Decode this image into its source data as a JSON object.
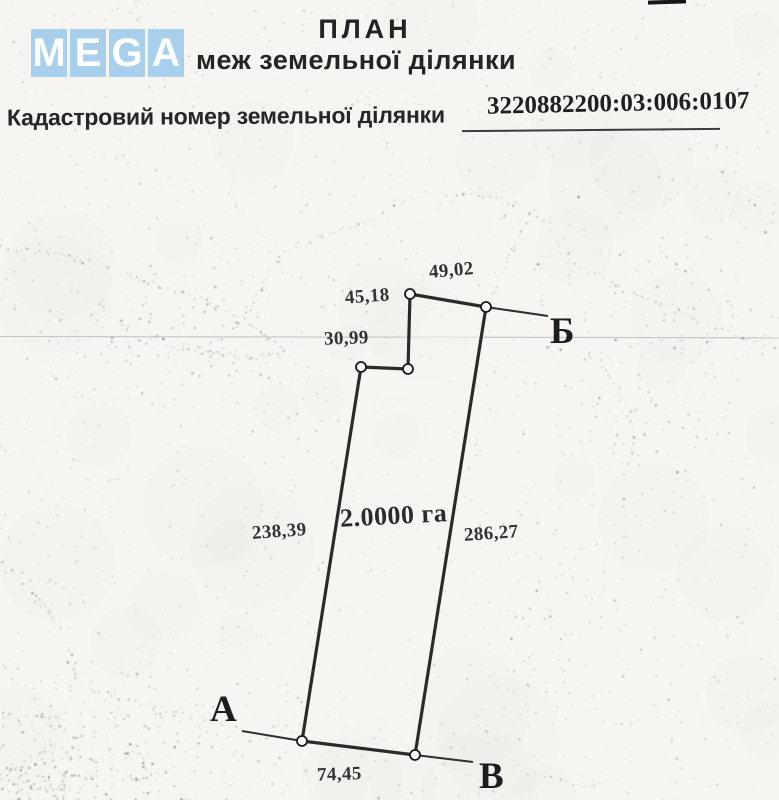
{
  "logo": {
    "letters": [
      "M",
      "E",
      "G",
      "A"
    ],
    "tile_color": "#a8d0ec",
    "letter_color": "#ffffff"
  },
  "header": {
    "title": "ПЛАН",
    "subtitle": "меж земельної ділянки"
  },
  "cadastral": {
    "label": "Кадастровий номер земельної ділянки",
    "number": "3220882200:03:006:0107"
  },
  "plan": {
    "area_label": "2.0000 га",
    "ink_color": "#1a1a1a",
    "vertices": [
      {
        "x": 410,
        "y": 294
      },
      {
        "x": 486,
        "y": 307
      },
      {
        "x": 415,
        "y": 755
      },
      {
        "x": 302,
        "y": 741
      },
      {
        "x": 361,
        "y": 367
      },
      {
        "x": 408,
        "y": 369
      }
    ],
    "extensions": [
      {
        "x1": 486,
        "y1": 307,
        "x2": 548,
        "y2": 316
      },
      {
        "x1": 242,
        "y1": 731,
        "x2": 302,
        "y2": 741
      },
      {
        "x1": 415,
        "y1": 755,
        "x2": 473,
        "y2": 762
      }
    ],
    "dimensions": [
      {
        "text": "49,02"
      },
      {
        "text": "45,18"
      },
      {
        "text": "30,99"
      },
      {
        "text": "238,39"
      },
      {
        "text": "286,27"
      },
      {
        "text": "74,45"
      }
    ],
    "points": [
      {
        "text": "А"
      },
      {
        "text": "Б"
      },
      {
        "text": "В"
      }
    ],
    "artifact_line_y": 337
  }
}
